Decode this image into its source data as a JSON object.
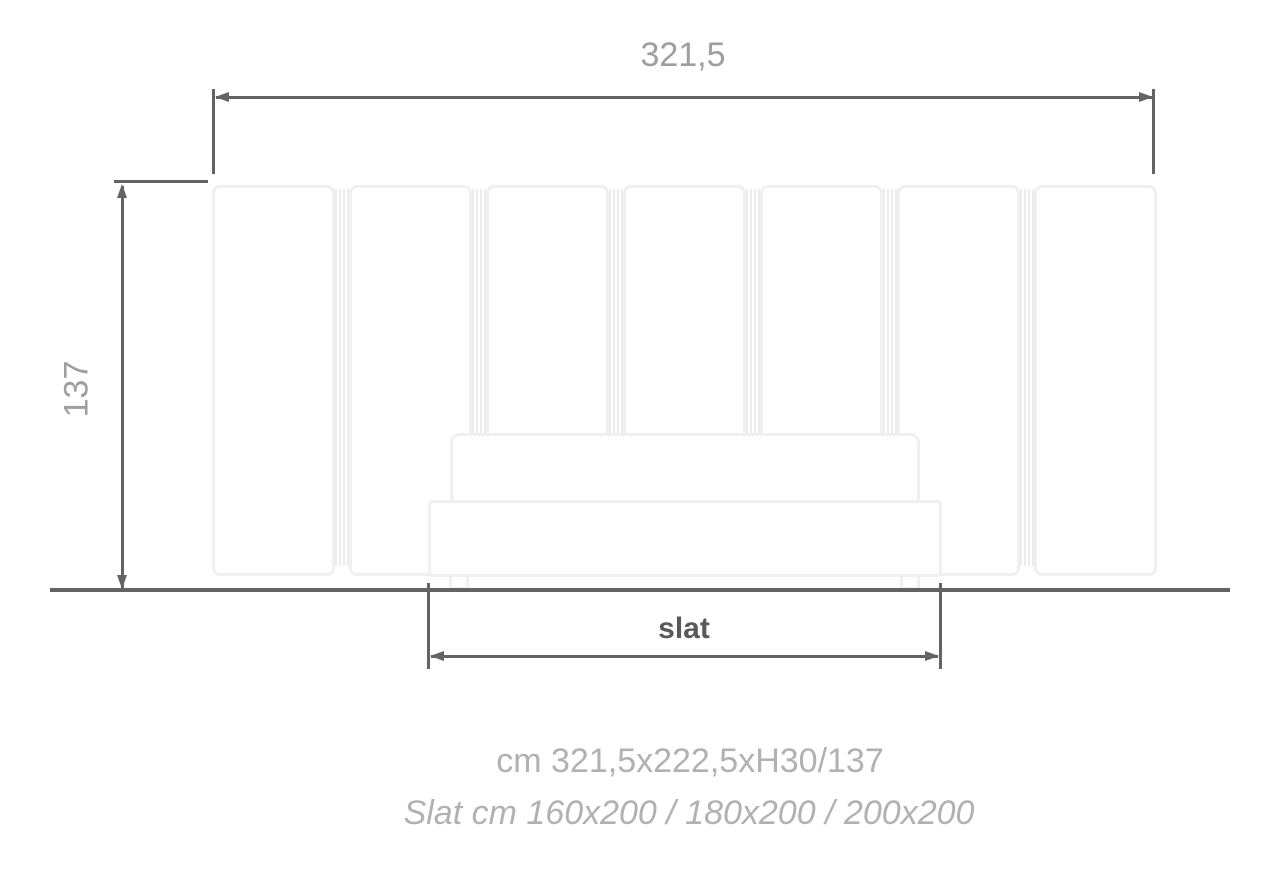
{
  "drawing_title": "bed-elevation-technical-drawing",
  "colors": {
    "dimension_line": "#636363",
    "dimension_text": "#9e9e9e",
    "slat_label_text": "#595959",
    "caption_text": "#b1b1b1",
    "furniture_outline": "#f0f0f0",
    "connector_line": "#ececec",
    "background": "#ffffff"
  },
  "dimensions": {
    "overall_width": {
      "label": "321,5"
    },
    "overall_height": {
      "label": "137"
    },
    "slat": {
      "label": "slat"
    }
  },
  "captions": {
    "overall_size": "cm 321,5x222,5xH30/137",
    "slat_sizes": "Slat cm 160x200 / 180x200 / 200x200"
  },
  "furniture": {
    "headboard_panel_count": 7,
    "panel_lefts": [
      212,
      349,
      486,
      623,
      760,
      897,
      1034
    ],
    "connector_lefts": [
      335,
      472,
      609,
      746,
      883,
      1020
    ],
    "feet_lefts": [
      449,
      900
    ]
  }
}
